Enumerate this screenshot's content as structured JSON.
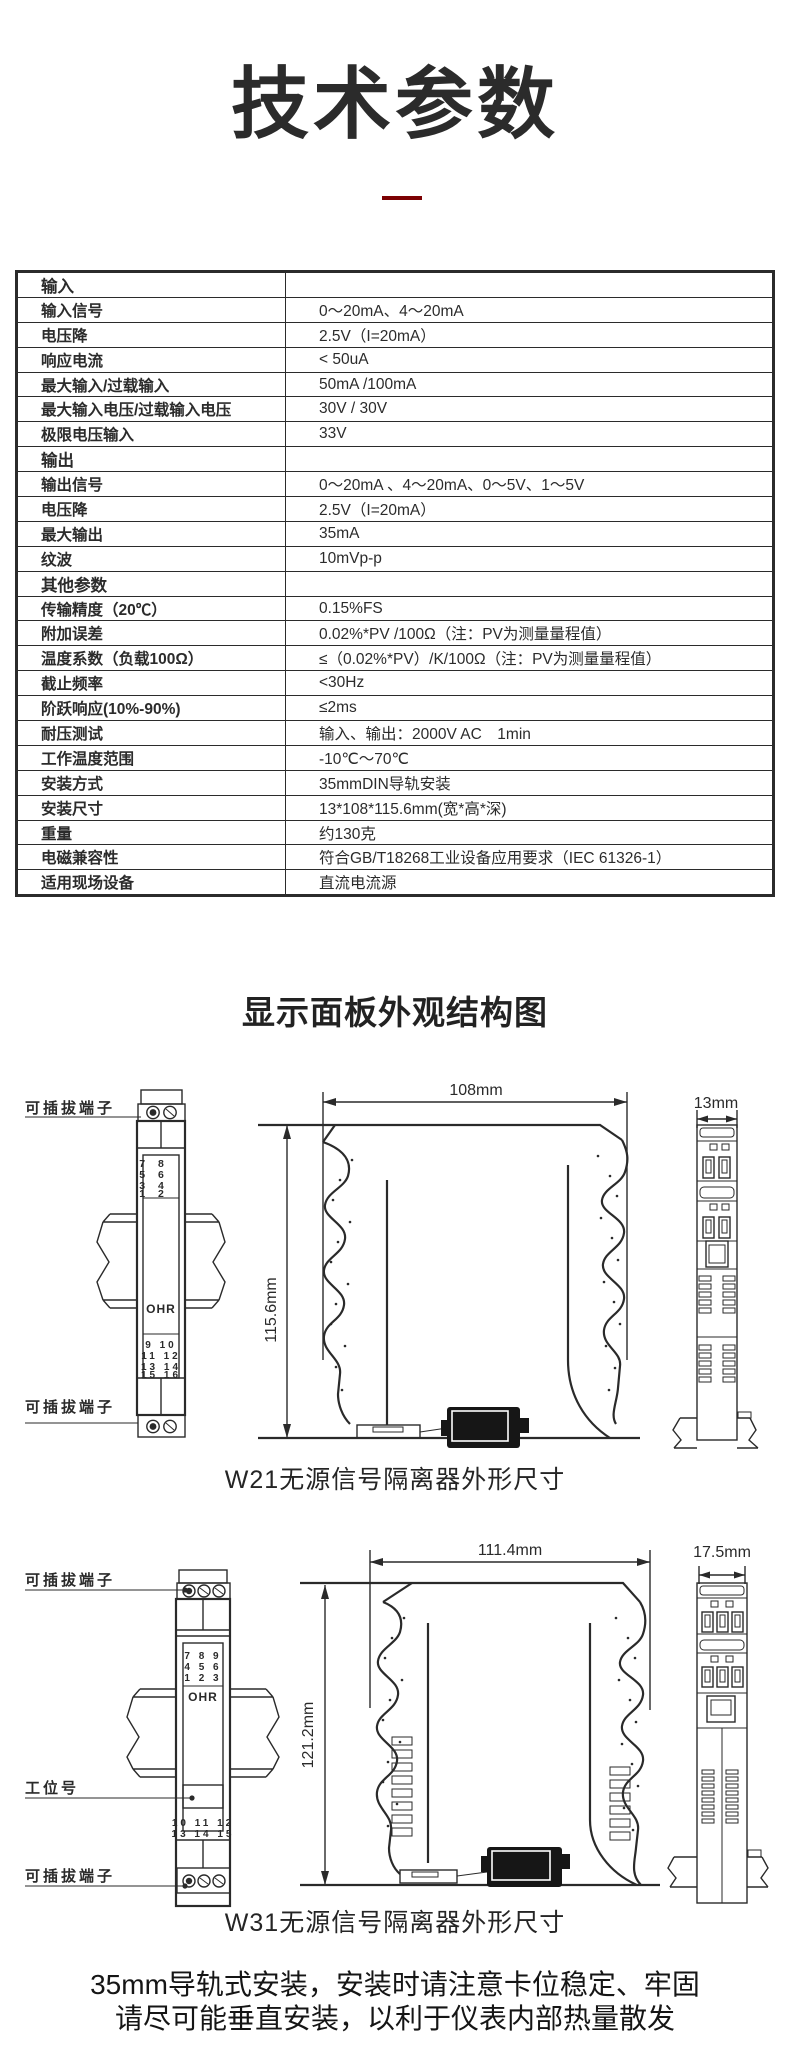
{
  "page": {
    "title": "技术参数",
    "section2_heading": "显示面板外观结构图",
    "footer_line1": "35mm导轨式安装，安装时请注意卡位稳定、牢固",
    "footer_line2": "请尽可能垂直安装，以利于仪表内部热量散发",
    "accent_color": "#7c0103",
    "ink_color": "#2a2a2a"
  },
  "spec_table": {
    "rows": [
      {
        "label": "输入",
        "value": "",
        "section": true
      },
      {
        "label": "输入信号",
        "value": "0～20mA、4～20mA",
        "section": false
      },
      {
        "label": "电压降",
        "value": "2.5V（I=20mA）",
        "section": false
      },
      {
        "label": "响应电流",
        "value": "< 50uA",
        "section": false
      },
      {
        "label": "最大输入/过载输入",
        "value": "50mA /100mA",
        "section": false
      },
      {
        "label": "最大输入电压/过载输入电压",
        "value": "30V / 30V",
        "section": false
      },
      {
        "label": "极限电压输入",
        "value": "33V",
        "section": false
      },
      {
        "label": "输出",
        "value": "",
        "section": true
      },
      {
        "label": "输出信号",
        "value": "0～20mA 、4～20mA、0～5V、1～5V",
        "section": false
      },
      {
        "label": "电压降",
        "value": "2.5V（I=20mA）",
        "section": false
      },
      {
        "label": "最大输出",
        "value": "35mA",
        "section": false
      },
      {
        "label": "纹波",
        "value": "10mVp-p",
        "section": false
      },
      {
        "label": "其他参数",
        "value": "",
        "section": true
      },
      {
        "label": "传输精度（20℃）",
        "value": "0.15%FS",
        "section": false
      },
      {
        "label": "附加误差",
        "value": "0.02%*PV /100Ω（注：PV为测量量程值）",
        "section": false
      },
      {
        "label": "温度系数（负载100Ω）",
        "value": "≤（0.02%*PV）/K/100Ω（注：PV为测量量程值）",
        "section": false
      },
      {
        "label": "截止频率",
        "value": "<30Hz",
        "section": false
      },
      {
        "label": "阶跃响应(10%-90%)",
        "value": "≤2ms",
        "section": false
      },
      {
        "label": "耐压测试",
        "value": "输入、输出：2000V AC　1min",
        "section": false
      },
      {
        "label": "工作温度范围",
        "value": "-10℃～70℃",
        "section": false
      },
      {
        "label": "安装方式",
        "value": "35mmDIN导轨安装",
        "section": false
      },
      {
        "label": "安装尺寸",
        "value": "13*108*115.6mm(宽*高*深)",
        "section": false
      },
      {
        "label": "重量",
        "value": "约130克",
        "section": false
      },
      {
        "label": "电磁兼容性",
        "value": "符合GB/T18268工业设备应用要求（IEC 61326-1）",
        "section": false
      },
      {
        "label": "适用现场设备",
        "value": "直流电流源",
        "section": false
      }
    ]
  },
  "w21": {
    "caption": "W21无源信号隔离器外形尺寸",
    "label_terminal_top": "可插拔端子",
    "label_terminal_bottom": "可插拔端子",
    "brand": "OHR",
    "dim_width": "108mm",
    "dim_height": "115.6mm",
    "dim_front_width": "13mm",
    "terminals_top": [
      "7 8",
      "5 6",
      "3 4",
      "1 2"
    ],
    "terminals_bottom": [
      "9 10",
      "11 12",
      "13 14",
      "15 16"
    ]
  },
  "w31": {
    "caption": "W31无源信号隔离器外形尺寸",
    "label_terminal_top": "可插拔端子",
    "label_station": "工位号",
    "label_terminal_bottom": "可插拔端子",
    "brand": "OHR",
    "dim_width": "111.4mm",
    "dim_height": "121.2mm",
    "dim_front_width": "17.5mm",
    "terminals_top": [
      "7 8 9",
      "4 5 6",
      "1 2 3"
    ],
    "terminals_bottom": [
      "10 11 12",
      "13 14 15"
    ]
  }
}
